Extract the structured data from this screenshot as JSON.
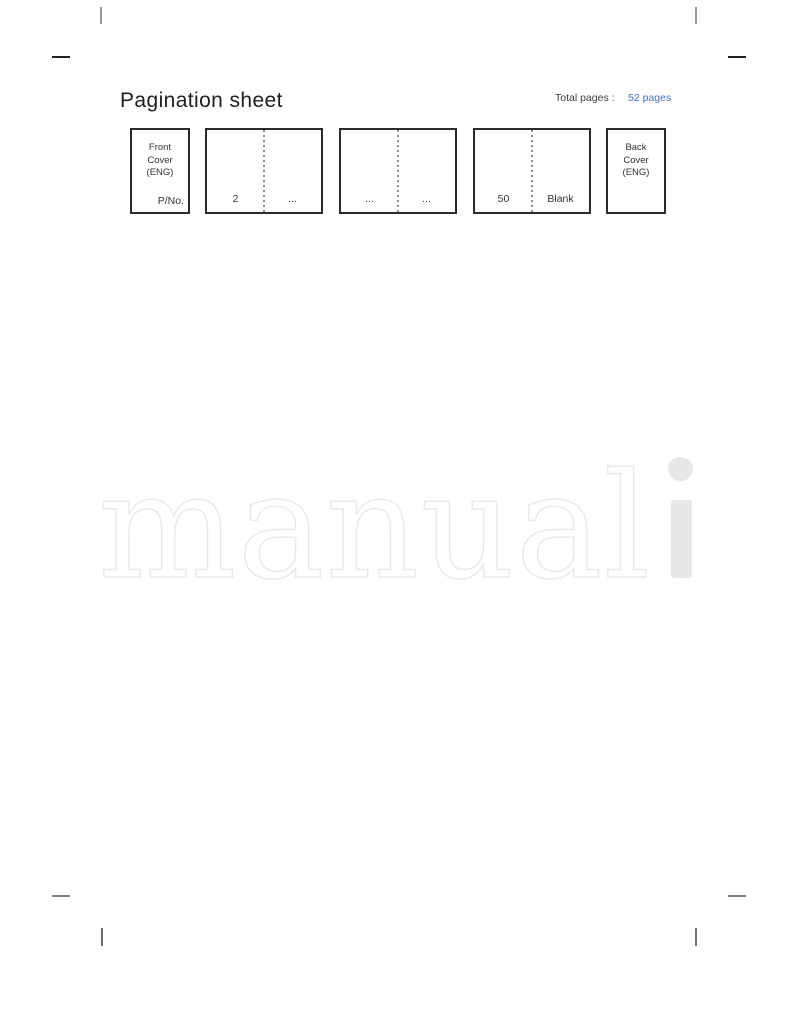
{
  "header": {
    "title": "Pagination sheet",
    "total_pages_label": "Total pages :",
    "total_pages_value": "52 pages",
    "total_pages_value_color": "#4573c5"
  },
  "pagination_boxes": {
    "front_cover": {
      "lines": [
        "Front",
        "Cover",
        "(ENG)"
      ],
      "part_number_label": "P/No."
    },
    "spread_1": {
      "left_page": "2",
      "right_page": "..."
    },
    "spread_2": {
      "left_page": "...",
      "right_page": "..."
    },
    "spread_3": {
      "left_page": "50",
      "right_page": "Blank"
    },
    "back_cover": {
      "lines": [
        "Back",
        "Cover",
        "(ENG)"
      ]
    }
  },
  "watermark": {
    "outline_text": "manual",
    "solid_text": "i",
    "outline_color": "#e9e9e9",
    "solid_color": "#e7e7e7"
  }
}
